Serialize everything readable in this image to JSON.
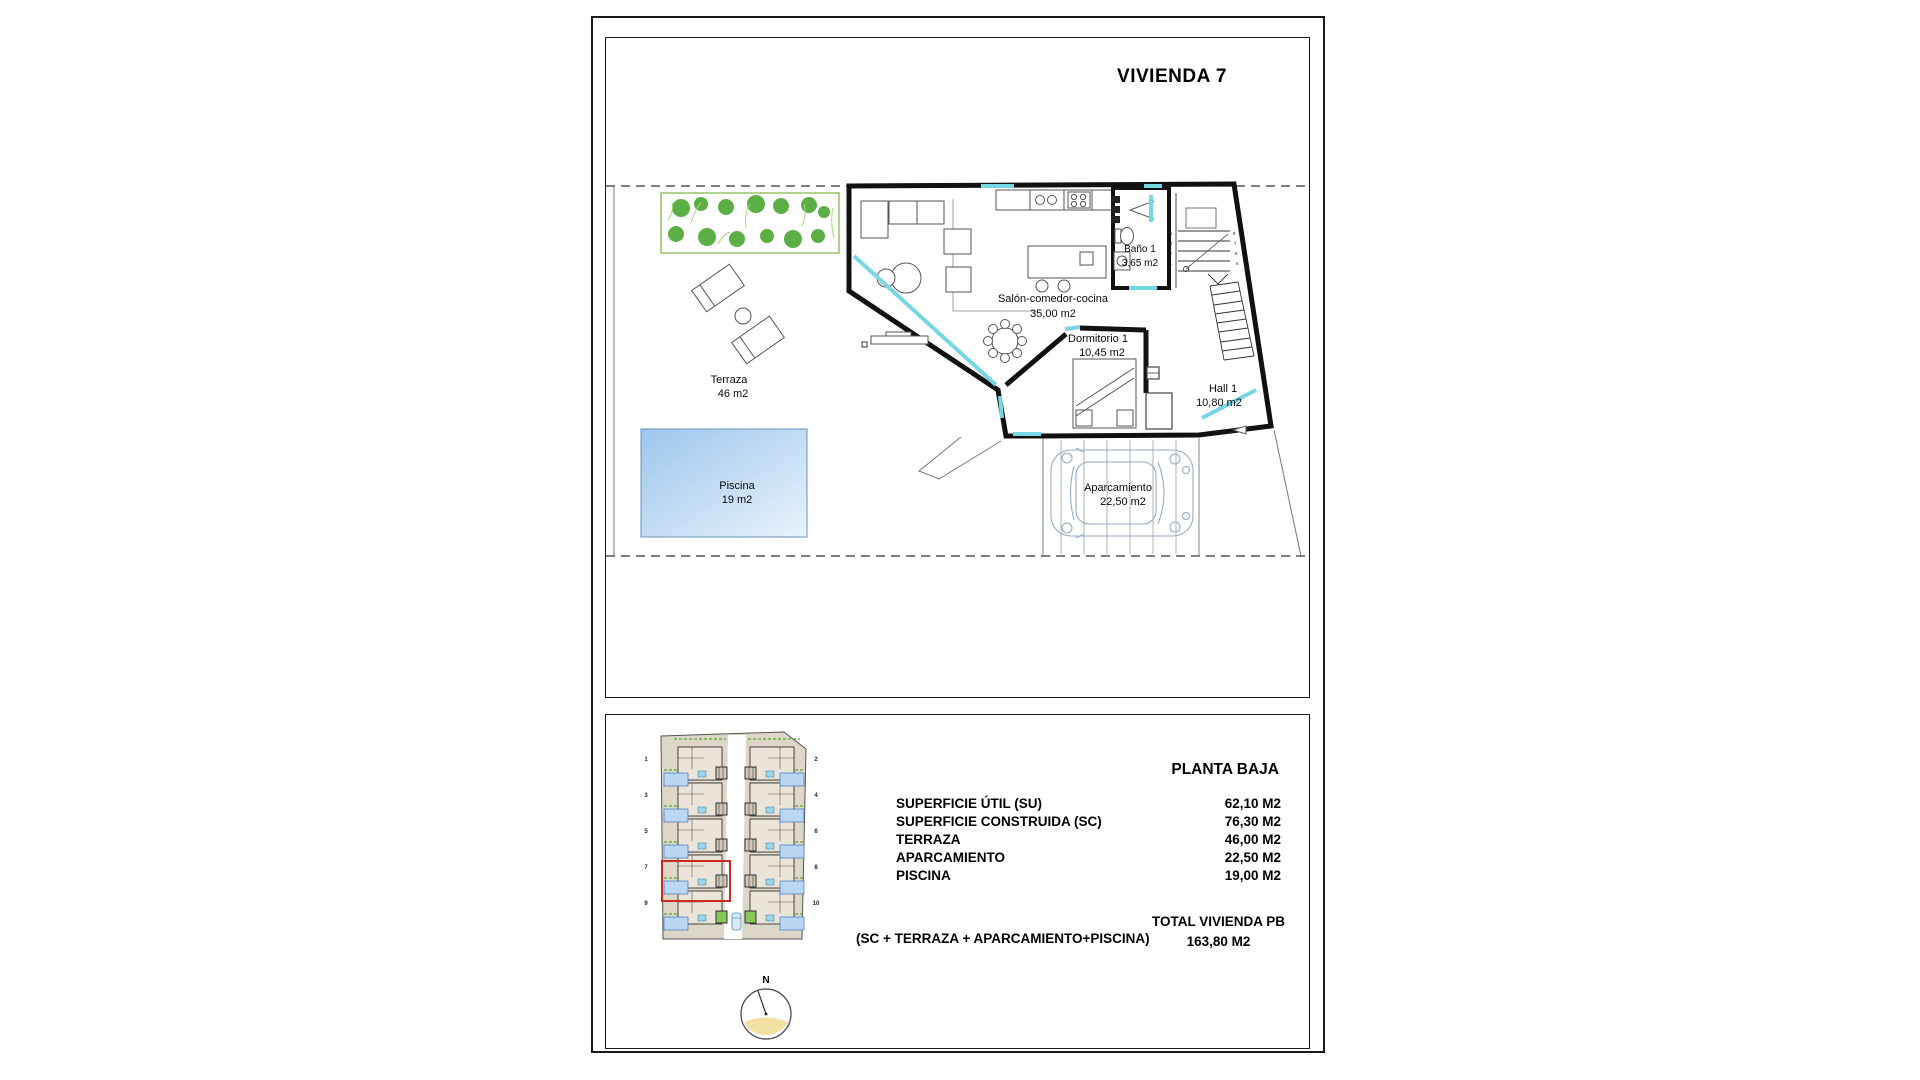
{
  "document": {
    "title": "VIVIENDA 7"
  },
  "floor_plan": {
    "rooms": {
      "terraza": {
        "name": "Terraza",
        "area": "46 m2"
      },
      "piscina": {
        "name": "Piscina",
        "area": "19 m2"
      },
      "salon": {
        "name": "Salón-comedor-cocina",
        "area": "35,00 m2"
      },
      "bano": {
        "name": "Baño 1",
        "area": "3,65 m2"
      },
      "dormitorio": {
        "name": "Dormitorio 1",
        "area": "10,45 m2"
      },
      "hall": {
        "name": "Hall 1",
        "area": "10,80 m2"
      },
      "aparcamiento": {
        "name": "Aparcamiento",
        "area": "22,50 m2"
      }
    },
    "stairs": {
      "left_step_numbers": [
        "4",
        "3",
        "2",
        "1"
      ],
      "right_step_numbers": [
        "8",
        "7",
        "6",
        "5"
      ]
    }
  },
  "summary": {
    "header": "PLANTA BAJA",
    "rows": [
      {
        "label": "SUPERFICIE ÚTIL (SU)",
        "value": "62,10 M2"
      },
      {
        "label": "SUPERFICIE CONSTRUIDA (SC)",
        "value": "76,30 M2"
      },
      {
        "label": "TERRAZA",
        "value": "46,00 M2"
      },
      {
        "label": "APARCAMIENTO",
        "value": "22,50 M2"
      },
      {
        "label": "PISCINA",
        "value": "19,00 M2"
      }
    ],
    "total_formula": "(SC + TERRAZA + APARCAMIENTO+PISCINA)",
    "total_label": "TOTAL VIVIENDA PB",
    "total_value": "163,80 M2"
  },
  "site_plan": {
    "left_unit_numbers": [
      "1",
      "3",
      "5",
      "7",
      "9"
    ],
    "right_unit_numbers": [
      "2",
      "4",
      "6",
      "8",
      "10"
    ],
    "highlighted_unit": "7"
  },
  "compass": {
    "north_label": "N"
  },
  "colors": {
    "window_accent": "#76d6e3",
    "pool_top": "#9cc6ec",
    "pool_bottom": "#e9f3fc",
    "garden_green": "#46a42c",
    "highlight_red": "#cc2a1e"
  }
}
